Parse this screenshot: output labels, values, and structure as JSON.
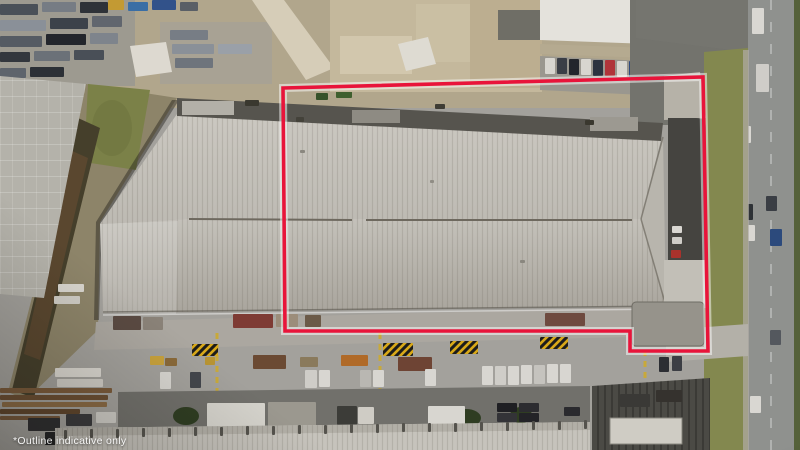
{
  "image": {
    "description": "Aerial drone photograph of an industrial warehouse property marked with a red boundary outline, surrounded by yards, parked vehicles, trees and a road",
    "disclaimer_text": "*Outline indicative only"
  },
  "boundary_overlay": {
    "color": "#e8143a",
    "glow_color": "#ffffff",
    "points": "283,88 703,77 708,351 630,351 630,331 285,331"
  },
  "palette": {
    "concrete": "#a3a19c",
    "yard_tan": "#b1a68c",
    "roof_light": "#c9c6bf",
    "roof_shade": "#aaa69e",
    "roof_dark_strip": "#56544e",
    "grass": "#83884f",
    "tree": "#42542a",
    "road": "#8f918e",
    "asphalt": "#73736d",
    "hazard_yellow": "#d8a818"
  },
  "scene": {
    "scrap_cars": {
      "shape": "rect",
      "item_name": "scrap-vehicle",
      "items": [
        [
          0,
          4,
          38,
          11,
          "#4a5058"
        ],
        [
          42,
          2,
          34,
          10,
          "#767c84"
        ],
        [
          80,
          2,
          28,
          11,
          "#2e3238"
        ],
        [
          0,
          20,
          46,
          11,
          "#8a9098"
        ],
        [
          50,
          18,
          38,
          11,
          "#3c424a"
        ],
        [
          92,
          16,
          30,
          11,
          "#61666e"
        ],
        [
          0,
          36,
          42,
          11,
          "#555b63"
        ],
        [
          46,
          34,
          40,
          11,
          "#23262c"
        ],
        [
          90,
          33,
          28,
          11,
          "#7e848c"
        ],
        [
          0,
          52,
          30,
          10,
          "#33373d"
        ],
        [
          34,
          51,
          36,
          10,
          "#6b7178"
        ],
        [
          74,
          50,
          30,
          10,
          "#494f57"
        ],
        [
          0,
          68,
          26,
          10,
          "#5e646c"
        ],
        [
          30,
          67,
          34,
          10,
          "#2c3036"
        ],
        [
          170,
          30,
          38,
          10,
          "#777d85"
        ],
        [
          172,
          44,
          42,
          10,
          "#8a9098"
        ],
        [
          175,
          58,
          38,
          10,
          "#6e747c"
        ],
        [
          218,
          44,
          34,
          10,
          "#9aa0a8"
        ]
      ]
    },
    "top_colored_bits": {
      "shape": "rect",
      "item_name": "yard-object",
      "items": [
        [
          108,
          0,
          16,
          10,
          "#c39a33"
        ],
        [
          128,
          2,
          20,
          9,
          "#3a6ea5"
        ],
        [
          152,
          0,
          24,
          10,
          "#32528a"
        ],
        [
          180,
          2,
          18,
          9,
          "#5a5f66"
        ],
        [
          350,
          0,
          22,
          12,
          "#b8862e"
        ],
        [
          374,
          2,
          16,
          10,
          "#3f4f66"
        ],
        [
          450,
          4,
          28,
          12,
          "#3d5e9e"
        ],
        [
          485,
          2,
          30,
          12,
          "#cfd2d6"
        ],
        [
          466,
          0,
          26,
          10,
          "#4660a0"
        ],
        [
          495,
          60,
          15,
          18,
          "#a93226"
        ],
        [
          336,
          90,
          16,
          8,
          "#3f5f2e"
        ],
        [
          316,
          93,
          12,
          7,
          "#36522a"
        ]
      ]
    },
    "top_parked_cars": {
      "shape": "rect",
      "item_name": "parked-car",
      "items": [
        [
          545,
          58,
          10,
          16,
          "#d8d6d0"
        ],
        [
          557,
          58,
          10,
          16,
          "#3a3e46"
        ],
        [
          569,
          59,
          10,
          16,
          "#23262c"
        ],
        [
          581,
          59,
          10,
          16,
          "#d8d6d0"
        ],
        [
          593,
          60,
          10,
          16,
          "#2c3340"
        ],
        [
          605,
          60,
          10,
          16,
          "#b0343a"
        ],
        [
          617,
          61,
          10,
          16,
          "#d8d6d0"
        ],
        [
          629,
          61,
          10,
          16,
          "#2f4a7e"
        ],
        [
          641,
          62,
          10,
          15,
          "#d8d6d0"
        ]
      ]
    },
    "road_cars": {
      "shape": "rect",
      "item_name": "car",
      "items": [
        [
          752,
          8,
          12,
          26,
          "#d9d7d2"
        ],
        [
          756,
          64,
          13,
          28,
          "#cfcdc8"
        ],
        [
          740,
          126,
          11,
          17,
          "#d9d7d2"
        ],
        [
          766,
          196,
          11,
          15,
          "#3a3e44"
        ],
        [
          742,
          204,
          11,
          16,
          "#2e3236"
        ],
        [
          744,
          225,
          11,
          16,
          "#d9d7d2"
        ],
        [
          770,
          229,
          12,
          17,
          "#2c4a7c"
        ],
        [
          770,
          330,
          11,
          15,
          "#54585e"
        ],
        [
          750,
          396,
          11,
          17,
          "#d9d7d2"
        ]
      ]
    },
    "trees": {
      "shape": "circle",
      "item_name": "tree",
      "items": [
        [
          196,
          52,
          14,
          12,
          "#3f5129"
        ],
        [
          214,
          70,
          13,
          11,
          "#47592d"
        ],
        [
          232,
          48,
          12,
          10,
          "#3a4c26"
        ],
        [
          250,
          66,
          14,
          11,
          "#42542a"
        ],
        [
          268,
          46,
          11,
          9,
          "#4a5c30"
        ],
        [
          240,
          88,
          12,
          9,
          "#3f5129"
        ],
        [
          210,
          92,
          11,
          8,
          "#364824"
        ],
        [
          650,
          10,
          13,
          10,
          "#47592d"
        ],
        [
          668,
          28,
          16,
          13,
          "#3d4f28"
        ],
        [
          690,
          60,
          17,
          13,
          "#46582c"
        ],
        [
          672,
          95,
          14,
          11,
          "#3a4c26"
        ],
        [
          700,
          115,
          13,
          10,
          "#42542a"
        ],
        [
          660,
          120,
          10,
          7,
          "#3e5028"
        ],
        [
          648,
          133,
          9,
          6,
          "#475a2e"
        ],
        [
          714,
          75,
          13,
          11,
          "#44552c"
        ],
        [
          727,
          98,
          11,
          9,
          "#52643a"
        ],
        [
          711,
          120,
          10,
          9,
          "#3c4e27"
        ],
        [
          719,
          258,
          13,
          10,
          "#44552c"
        ],
        [
          713,
          290,
          11,
          9,
          "#3a4c26"
        ],
        [
          723,
          322,
          12,
          10,
          "#4d5f33"
        ],
        [
          716,
          420,
          14,
          11,
          "#42542a"
        ],
        [
          731,
          442,
          12,
          9,
          "#364824"
        ],
        [
          788,
          78,
          13,
          11,
          "#44552c"
        ],
        [
          793,
          170,
          11,
          10,
          "#3d4f28"
        ],
        [
          789,
          310,
          13,
          11,
          "#46582c"
        ],
        [
          794,
          365,
          10,
          9,
          "#3a4c26"
        ],
        [
          752,
          445,
          14,
          9,
          "#3f5129"
        ]
      ]
    },
    "hatch_signs": {
      "shape": "rect",
      "item_name": "hazard-marking",
      "fill": "url(#hazard)",
      "items": [
        [
          192,
          344,
          26,
          12
        ],
        [
          383,
          343,
          30,
          13
        ],
        [
          450,
          341,
          28,
          13
        ],
        [
          540,
          337,
          28,
          12
        ]
      ]
    },
    "containers": {
      "shape": "rect",
      "item_name": "container",
      "items": [
        [
          253,
          355,
          33,
          14,
          "#6b4a33"
        ],
        [
          341,
          355,
          27,
          11,
          "#b06a28"
        ],
        [
          398,
          357,
          34,
          14,
          "#6e4434"
        ],
        [
          300,
          357,
          18,
          10,
          "#8a7a5c"
        ],
        [
          150,
          356,
          14,
          9,
          "#c8a23c"
        ],
        [
          205,
          357,
          10,
          8,
          "#b89433"
        ],
        [
          165,
          358,
          12,
          8,
          "#8a6a3a"
        ]
      ]
    },
    "canopies": {
      "shape": "rect",
      "item_name": "canopy-roof",
      "items": [
        [
          55,
          368,
          46,
          9,
          "#dad7d0"
        ],
        [
          57,
          379,
          46,
          8,
          "#d0cdc6"
        ],
        [
          58,
          284,
          26,
          8,
          "#d8d5ce"
        ],
        [
          54,
          296,
          26,
          8,
          "#cfccc5"
        ]
      ]
    },
    "stacks": {
      "shape": "rect",
      "item_name": "material-stack",
      "items": [
        [
          0,
          388,
          112,
          5,
          "#7a5a3a"
        ],
        [
          0,
          395,
          108,
          5,
          "#6b4e32"
        ],
        [
          2,
          402,
          105,
          5,
          "#8a6a44"
        ],
        [
          0,
          409,
          80,
          5,
          "#5f452c"
        ],
        [
          0,
          416,
          60,
          4,
          "#75573a"
        ]
      ]
    },
    "yard_cars": {
      "shape": "rect",
      "item_name": "parked-vehicle",
      "items": [
        [
          160,
          372,
          11,
          17,
          "#d8d6d1"
        ],
        [
          190,
          372,
          11,
          16,
          "#43464c"
        ],
        [
          305,
          370,
          12,
          18,
          "#cfcdc8"
        ],
        [
          319,
          370,
          11,
          17,
          "#d8d6d1"
        ],
        [
          360,
          370,
          11,
          17,
          "#b9b7b2"
        ],
        [
          373,
          370,
          11,
          17,
          "#d8d6d1"
        ],
        [
          425,
          369,
          11,
          17,
          "#d8d6d1"
        ],
        [
          482,
          366,
          11,
          19,
          "#d8d6d1"
        ],
        [
          495,
          366,
          11,
          19,
          "#cfcdc8"
        ],
        [
          508,
          366,
          11,
          19,
          "#d8d6d1"
        ],
        [
          521,
          365,
          11,
          19,
          "#d8d6d1"
        ],
        [
          534,
          365,
          11,
          19,
          "#c5c3be"
        ],
        [
          547,
          364,
          11,
          19,
          "#d8d6d1"
        ],
        [
          560,
          364,
          11,
          19,
          "#d8d6d1"
        ],
        [
          659,
          357,
          10,
          15,
          "#2c2e33"
        ],
        [
          672,
          356,
          10,
          15,
          "#3c3e44"
        ]
      ]
    },
    "bl_cars": {
      "shape": "rect",
      "item_name": "parked-vehicle",
      "items": [
        [
          28,
          418,
          32,
          13,
          "#2e2e30"
        ],
        [
          66,
          414,
          26,
          12,
          "#3a3a3c"
        ],
        [
          96,
          412,
          20,
          11,
          "#cfcdc7"
        ],
        [
          45,
          432,
          30,
          13,
          "#232325"
        ],
        [
          120,
          430,
          26,
          12,
          "#2c2c2e"
        ]
      ]
    },
    "hedges": {
      "shape": "circle",
      "item_name": "hedge",
      "fill": "#2f3d22",
      "items": [
        [
          186,
          416,
          13,
          9
        ],
        [
          466,
          418,
          15,
          9
        ],
        [
          521,
          415,
          11,
          8
        ],
        [
          237,
          415,
          10,
          8
        ]
      ]
    },
    "bottom_units": {
      "shape": "rect",
      "item_name": "rooftop-unit",
      "items": [
        [
          207,
          403,
          58,
          24,
          "#d5d3cc"
        ],
        [
          268,
          402,
          48,
          25,
          "#9b988f"
        ],
        [
          337,
          406,
          20,
          19,
          "#3c3c38"
        ],
        [
          358,
          407,
          16,
          17,
          "#cfccc5"
        ],
        [
          428,
          406,
          37,
          21,
          "#d8d6d0"
        ],
        [
          497,
          403,
          20,
          9,
          "#1f1f23"
        ],
        [
          519,
          403,
          20,
          9,
          "#2c2c30"
        ],
        [
          497,
          413,
          20,
          9,
          "#333337"
        ],
        [
          519,
          413,
          20,
          9,
          "#232327"
        ],
        [
          564,
          407,
          16,
          9,
          "#2a2a2e"
        ]
      ]
    },
    "bottom_ribs": {
      "shape": "rect",
      "item_name": "roof-rib-tick",
      "fill": "#55534d",
      "items": [
        [
          64,
          430,
          3,
          9
        ],
        [
          90,
          429,
          3,
          9
        ],
        [
          116,
          429,
          3,
          9
        ],
        [
          142,
          428,
          3,
          9
        ],
        [
          168,
          428,
          3,
          9
        ],
        [
          194,
          427,
          3,
          9
        ],
        [
          220,
          427,
          3,
          9
        ],
        [
          246,
          426,
          3,
          9
        ],
        [
          272,
          426,
          3,
          9
        ],
        [
          298,
          425,
          3,
          9
        ],
        [
          324,
          425,
          3,
          9
        ],
        [
          350,
          424,
          3,
          9
        ],
        [
          376,
          424,
          3,
          9
        ],
        [
          402,
          423,
          3,
          9
        ],
        [
          428,
          423,
          3,
          9
        ],
        [
          454,
          423,
          3,
          9
        ],
        [
          480,
          422,
          3,
          9
        ],
        [
          506,
          422,
          3,
          9
        ],
        [
          532,
          421,
          3,
          9
        ],
        [
          558,
          421,
          3,
          9
        ],
        [
          584,
          420,
          3,
          9
        ]
      ]
    },
    "dock_trucks": {
      "shape": "rect",
      "item_name": "dock-truck",
      "items": [
        [
          113,
          316,
          28,
          14,
          "#5a4a42"
        ],
        [
          143,
          317,
          20,
          13,
          "#8a8278"
        ],
        [
          233,
          314,
          40,
          14,
          "#7e3b34"
        ],
        [
          276,
          314,
          22,
          13,
          "#9c8d7a"
        ],
        [
          305,
          315,
          16,
          12,
          "#6b5a48"
        ],
        [
          545,
          313,
          40,
          13,
          "#6e4a3f"
        ]
      ]
    },
    "roof_marks": {
      "shape": "rect",
      "item_name": "roof-detail",
      "items": [
        [
          245,
          100,
          14,
          6,
          "#3a382f"
        ],
        [
          296,
          117,
          8,
          5,
          "#44423a"
        ],
        [
          435,
          104,
          10,
          5,
          "#3f3d35"
        ],
        [
          585,
          120,
          9,
          5,
          "#3a382f"
        ],
        [
          300,
          150,
          5,
          3,
          "#8a877f"
        ],
        [
          430,
          180,
          4,
          3,
          "#908d85"
        ],
        [
          520,
          260,
          5,
          3,
          "#8a877f"
        ],
        [
          672,
          226,
          10,
          7,
          "#d9d7d2"
        ],
        [
          672,
          237,
          10,
          7,
          "#cfcdc8"
        ],
        [
          671,
          250,
          10,
          8,
          "#a8322c"
        ],
        [
          620,
          394,
          30,
          13,
          "#3a3936"
        ],
        [
          656,
          390,
          26,
          12,
          "#35322e"
        ]
      ]
    }
  }
}
